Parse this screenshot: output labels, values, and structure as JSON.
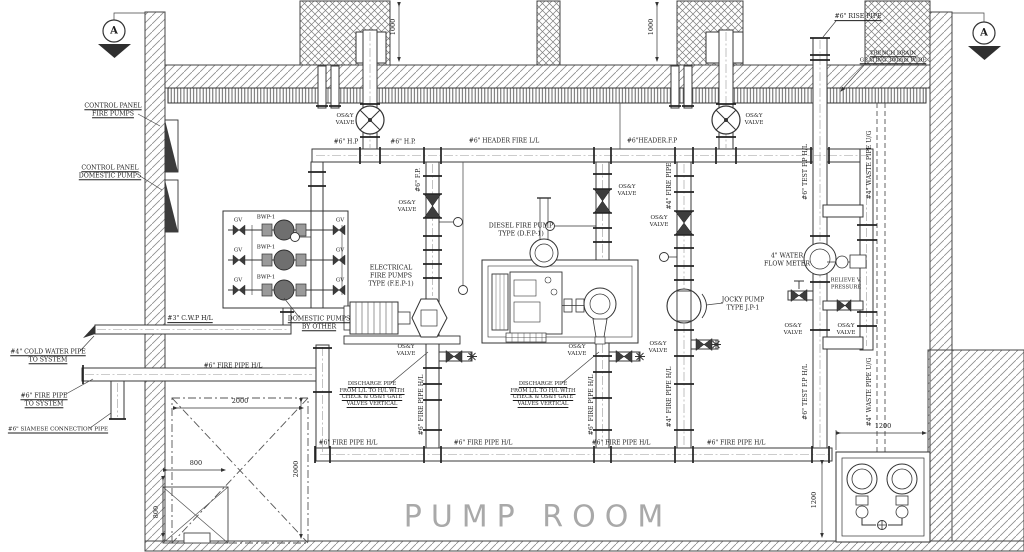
{
  "room_title": "PUMP ROOM",
  "section_marker_label": "A",
  "drawing": {
    "labels": [
      {
        "n": "label-control-panel-fire-pumps",
        "t": "CONTROL PANEL\nFIRE PUMPS",
        "x": 113,
        "y": 110,
        "u": 1
      },
      {
        "n": "label-control-panel-domestic-pumps",
        "t": "CONTROL PANEL\nDOMESTIC PUMPS",
        "x": 110,
        "y": 172,
        "u": 1
      },
      {
        "n": "label-cwp-hl",
        "t": "#3\" C.W.P H/L",
        "x": 190,
        "y": 319,
        "u": 1
      },
      {
        "n": "label-cold-water-pipe-to-system",
        "t": "#4\" COLD WATER PIPE\nTO SYSTEM",
        "x": 48,
        "y": 356,
        "u": 1
      },
      {
        "n": "label-fire-pipe-to-system",
        "t": "#6\" FIRE PIPE\nTO SYSTEM",
        "x": 44,
        "y": 400,
        "u": 1
      },
      {
        "n": "label-siamese-connection-pipe",
        "t": "#6\" SIAMESE CONNECTION PIPE",
        "x": 58,
        "y": 430,
        "u": 1,
        "s": 5.6
      },
      {
        "n": "label-gv-1",
        "t": "GV",
        "x": 238,
        "y": 221,
        "s": 5.5
      },
      {
        "n": "label-gv-2",
        "t": "GV",
        "x": 238,
        "y": 251,
        "s": 5.5
      },
      {
        "n": "label-gv-3",
        "t": "GV",
        "x": 238,
        "y": 281,
        "s": 5.5
      },
      {
        "n": "label-gv-4",
        "t": "GV",
        "x": 340,
        "y": 221,
        "s": 5.5
      },
      {
        "n": "label-gv-5",
        "t": "GV",
        "x": 340,
        "y": 251,
        "s": 5.5
      },
      {
        "n": "label-gv-6",
        "t": "GV",
        "x": 340,
        "y": 281,
        "s": 5.5
      },
      {
        "n": "label-bwp-1",
        "t": "BWP-1",
        "x": 266,
        "y": 218,
        "s": 5.5
      },
      {
        "n": "label-bwp-2",
        "t": "BWP-1",
        "x": 266,
        "y": 248,
        "s": 5.5
      },
      {
        "n": "label-bwp-3",
        "t": "BWP-1",
        "x": 266,
        "y": 278,
        "s": 5.5
      },
      {
        "n": "label-domestic-pumps-by-other",
        "t": "DOMESTIC PUMPS\nBY OTHER",
        "x": 319,
        "y": 323,
        "u": 1
      },
      {
        "n": "label-electrical-fire-pumps",
        "t": "ELECTRICAL\nFIRE PUMPS\nTYPE (F.E.P-1)",
        "x": 391,
        "y": 276
      },
      {
        "n": "label-diesel-fire-pump",
        "t": "DIESEL FIRE PUMP\nTYPE (D.F.P-1)",
        "x": 521,
        "y": 230
      },
      {
        "n": "label-jockey-pump",
        "t": "JOCKY PUMP\nTYPE J.P-1",
        "x": 743,
        "y": 304
      },
      {
        "n": "label-water-flow-meter",
        "t": "4\" WATER\nFLOW METER",
        "x": 787,
        "y": 260
      },
      {
        "n": "label-relieve-pressure",
        "t": "RELIEVE V.\nPRESSURE",
        "x": 846,
        "y": 284,
        "s": 5.2
      },
      {
        "n": "label-osy-valve-top-left",
        "t": "OS&Y\nVALVE",
        "x": 345,
        "y": 120,
        "s": 5.6
      },
      {
        "n": "label-osy-valve-top-right",
        "t": "OS&Y\nVALVE",
        "x": 754,
        "y": 120,
        "s": 5.6
      },
      {
        "n": "label-osy-valve-riser1",
        "t": "OS&Y\nVALVE",
        "x": 407,
        "y": 207,
        "s": 5.6
      },
      {
        "n": "label-osy-valve-riser2",
        "t": "OS&Y\nVALVE",
        "x": 627,
        "y": 191,
        "s": 5.6
      },
      {
        "n": "label-osy-valve-jockey",
        "t": "OS&Y\nVALVE",
        "x": 659,
        "y": 222,
        "s": 5.6
      },
      {
        "n": "label-osy-valve-riser1-bottom",
        "t": "OS&Y\nVALVE",
        "x": 406,
        "y": 351,
        "s": 5.6
      },
      {
        "n": "label-osy-valve-riser2-bottom",
        "t": "OS&Y\nVALVE",
        "x": 577,
        "y": 351,
        "s": 5.6
      },
      {
        "n": "label-osy-valve-jockey-bottom",
        "t": "OS&Y\nVALVE",
        "x": 658,
        "y": 348,
        "s": 5.6
      },
      {
        "n": "label-osy-valve-meter-left",
        "t": "OS&Y\nVALVE",
        "x": 793,
        "y": 330,
        "s": 5.6
      },
      {
        "n": "label-osy-valve-meter-right",
        "t": "OS&Y\nVALVE",
        "x": 846,
        "y": 330,
        "s": 5.6
      },
      {
        "n": "label-hp-1",
        "t": "#6\" H.P",
        "x": 346,
        "y": 142,
        "s": 6
      },
      {
        "n": "label-hp-2",
        "t": "#6\" H.P.",
        "x": 403,
        "y": 142,
        "s": 6
      },
      {
        "n": "label-header-fire",
        "t": "#6\" HEADER FIRE L/L",
        "x": 504,
        "y": 141,
        "s": 6
      },
      {
        "n": "label-header-fp",
        "t": "#6\"HEADER.F.P",
        "x": 652,
        "y": 141,
        "s": 6
      },
      {
        "n": "label-fp-riser",
        "t": "#6\" F.P.",
        "x": 419,
        "y": 180,
        "r": -90
      },
      {
        "n": "label-fire-pipe-4",
        "t": "#4\" FIRE PIPE",
        "x": 670,
        "y": 186,
        "r": -90
      },
      {
        "n": "label-test-fp-top",
        "t": "#6\" TEST F.P H/L",
        "x": 806,
        "y": 172,
        "r": -90
      },
      {
        "n": "label-waste-pipe-top",
        "t": "#4\" WASTE PIPE U/G",
        "x": 870,
        "y": 165,
        "r": -90
      },
      {
        "n": "label-fire6-riser1",
        "t": "#6\" FIRE PIPE H/L",
        "x": 422,
        "y": 405,
        "r": -90
      },
      {
        "n": "label-fire6-riser2",
        "t": "#6\" FIRE PIPE H/L",
        "x": 592,
        "y": 405,
        "r": -90
      },
      {
        "n": "label-fire4-riser-bottom",
        "t": "#4\" FIRE PIPE H/L",
        "x": 670,
        "y": 397,
        "r": -90
      },
      {
        "n": "label-test-fp-bottom",
        "t": "#6\" TEST F.P H/L",
        "x": 806,
        "y": 392,
        "r": -90
      },
      {
        "n": "label-waste-pipe-bottom",
        "t": "#4\" WASTE PIPE U/G",
        "x": 870,
        "y": 392,
        "r": -90
      },
      {
        "n": "label-fire6-h4",
        "t": "#6\" FIRE PIPE H/L",
        "x": 233,
        "y": 366,
        "s": 6
      },
      {
        "n": "label-fire6-main-1",
        "t": "#6\" FIRE PIPE H/L",
        "x": 348,
        "y": 443,
        "s": 6
      },
      {
        "n": "label-fire6-main-2",
        "t": "#6\" FIRE PIPE H/L",
        "x": 483,
        "y": 443,
        "s": 6
      },
      {
        "n": "label-fire6-main-3",
        "t": "#6\" FIRE PIPE H/L",
        "x": 621,
        "y": 443,
        "s": 6
      },
      {
        "n": "label-fire6-main-4",
        "t": "#6\" FIRE PIPE H/L",
        "x": 736,
        "y": 443,
        "s": 6
      },
      {
        "n": "label-discharge-note-1",
        "t": "DISCHARGE PIPE\nFROM L/L TO H/L WITH\nCHECK & OS&Y GATE\nVALVES VERTICAL",
        "x": 372,
        "y": 394,
        "s": 5.2,
        "u": 1
      },
      {
        "n": "label-discharge-note-2",
        "t": "DISCHARGE PIPE\nFROM L/L TO H/L WITH\nCHECK & OS&Y GATE\nVALVES VERTICAL",
        "x": 543,
        "y": 394,
        "s": 5.2,
        "u": 1
      },
      {
        "n": "label-rise-pipe",
        "t": "#6\" RISE PIPE",
        "x": 858,
        "y": 17,
        "u": 1
      },
      {
        "n": "label-trench-drain",
        "t": "TRENCH DRAIN\nGRATING 300mm WIDE",
        "x": 893,
        "y": 57,
        "s": 5.4,
        "u": 1
      },
      {
        "n": "dim-1000-left",
        "t": "1000",
        "x": 393,
        "y": 27,
        "r": -90,
        "s": 6.5
      },
      {
        "n": "dim-1000-right",
        "t": "1000",
        "x": 651,
        "y": 27,
        "r": -90,
        "s": 6.5
      },
      {
        "n": "dim-2000-top",
        "t": "2000",
        "x": 240,
        "y": 401,
        "s": 6.5
      },
      {
        "n": "dim-2000-right",
        "t": "2000",
        "x": 296,
        "y": 469,
        "r": -90,
        "s": 6.5
      },
      {
        "n": "dim-800-top",
        "t": "800",
        "x": 196,
        "y": 463,
        "s": 6.5
      },
      {
        "n": "dim-800-left",
        "t": "800",
        "x": 156,
        "y": 512,
        "r": -90,
        "s": 6.5
      },
      {
        "n": "dim-1200-top",
        "t": "1200",
        "x": 883,
        "y": 426,
        "s": 6.5
      },
      {
        "n": "dim-1200-left",
        "t": "1200",
        "x": 814,
        "y": 500,
        "r": -90,
        "s": 6.5
      }
    ]
  }
}
